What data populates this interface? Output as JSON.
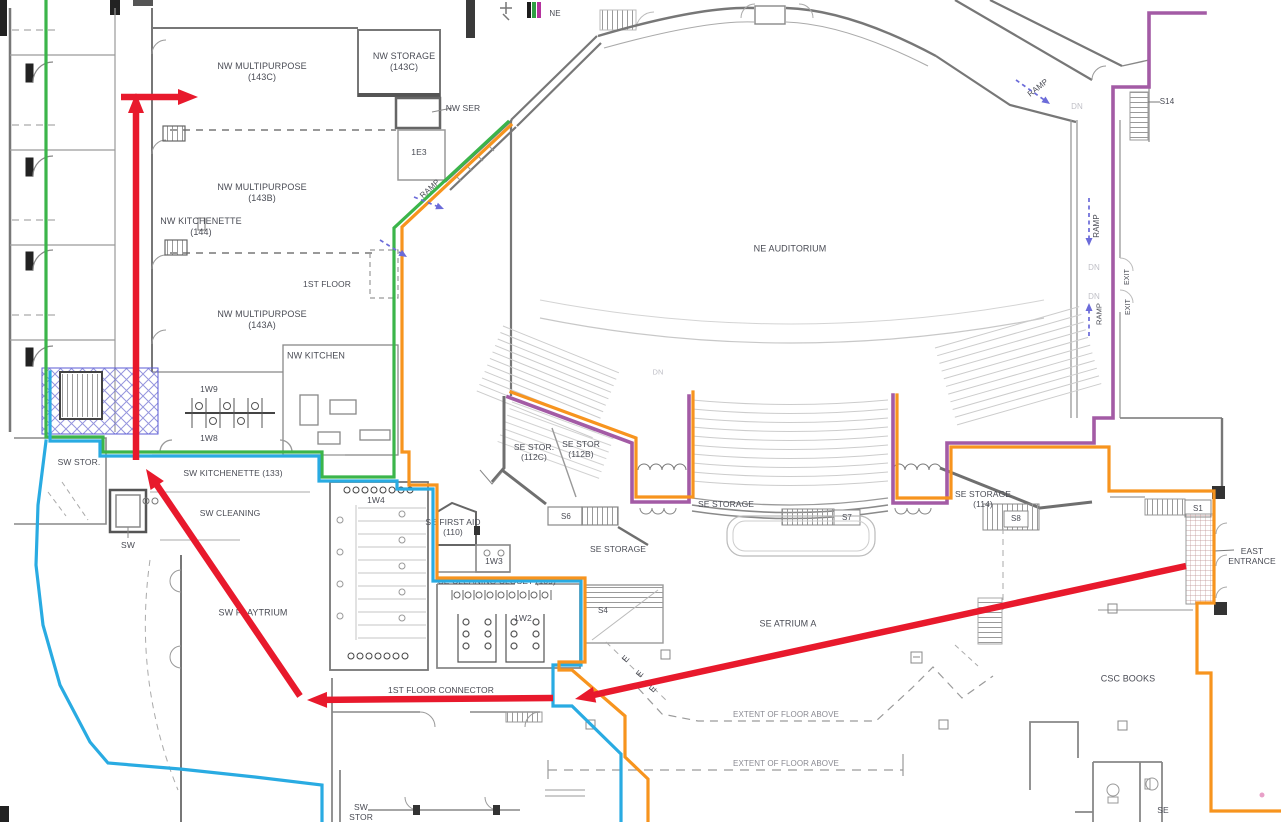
{
  "map_title": "First floor plan with wayfinding routes",
  "colors": {
    "red": "#E8192C",
    "blue": "#29ABE2",
    "orange": "#F7941E",
    "green": "#3BB54A",
    "purple": "#A35BA5",
    "ramp_arrow": "#6B6BD9",
    "text": "#4A4C55",
    "text_dim": "#BFBFC6"
  },
  "color_key_bars": [
    "#1C1C1C",
    "#2F9E43",
    "#B5329E"
  ],
  "labels": [
    {
      "name": "ne-corner",
      "text": "NE",
      "x": 555,
      "y": 14,
      "size": 8
    },
    {
      "name": "nw-multipurpose-143c",
      "text": "NW MULTIPURPOSE\n(143C)",
      "x": 262,
      "y": 72
    },
    {
      "name": "nw-storage-143c",
      "text": "NW STORAGE\n(143C)",
      "x": 404,
      "y": 62
    },
    {
      "name": "nw-ser",
      "text": "NW SER",
      "x": 463,
      "y": 108,
      "size": 8.5
    },
    {
      "name": "room-1e3",
      "text": "1E3",
      "x": 419,
      "y": 152,
      "size": 8.5
    },
    {
      "name": "ramp-nw",
      "text": "RAMP",
      "x": 430,
      "y": 189,
      "size": 8,
      "rot": -42
    },
    {
      "name": "nw-multipurpose-143b",
      "text": "NW MULTIPURPOSE\n(143B)",
      "x": 262,
      "y": 193
    },
    {
      "name": "nw-kitchenette-144",
      "text": "NW KITCHENETTE\n(144)",
      "x": 201,
      "y": 227
    },
    {
      "name": "first-floor",
      "text": "1ST FLOOR",
      "x": 327,
      "y": 284,
      "size": 8.5
    },
    {
      "name": "nw-multipurpose-143a",
      "text": "NW MULTIPURPOSE\n(143A)",
      "x": 262,
      "y": 320
    },
    {
      "name": "nw-kitchen",
      "text": "NW KITCHEN",
      "x": 316,
      "y": 356
    },
    {
      "name": "ne-auditorium",
      "text": "NE AUDITORIUM",
      "x": 790,
      "y": 249
    },
    {
      "name": "ramp-ne",
      "text": "RAMP",
      "x": 1038,
      "y": 88,
      "size": 8,
      "rot": -38
    },
    {
      "name": "dn-ne",
      "text": "DN",
      "x": 1077,
      "y": 107,
      "size": 8,
      "color": "#BFBFC6"
    },
    {
      "name": "s14",
      "text": "S14",
      "x": 1167,
      "y": 102,
      "size": 8
    },
    {
      "name": "ramp-east-upper",
      "text": "RAMP",
      "x": 1097,
      "y": 226,
      "size": 8,
      "rot": -90
    },
    {
      "name": "dn-east-1",
      "text": "DN",
      "x": 1094,
      "y": 268,
      "size": 8,
      "color": "#BFBFC6"
    },
    {
      "name": "dn-east-2",
      "text": "DN",
      "x": 1094,
      "y": 297,
      "size": 8,
      "color": "#BFBFC6"
    },
    {
      "name": "ramp-east-lower",
      "text": "RAMP",
      "x": 1099,
      "y": 314,
      "size": 7.5,
      "rot": -90
    },
    {
      "name": "exit-upper",
      "text": "EXIT",
      "x": 1128,
      "y": 277,
      "size": 7,
      "rot": -90
    },
    {
      "name": "exit-lower",
      "text": "EXIT",
      "x": 1129,
      "y": 307,
      "size": 7,
      "rot": -90
    },
    {
      "name": "room-1w9",
      "text": "1W9",
      "x": 209,
      "y": 389,
      "size": 8.5
    },
    {
      "name": "room-1w8",
      "text": "1W8",
      "x": 209,
      "y": 438,
      "size": 8.5
    },
    {
      "name": "sw-stor",
      "text": "SW STOR.",
      "x": 79,
      "y": 462,
      "size": 8.5
    },
    {
      "name": "sw-kitchenette-133",
      "text": "SW KITCHENETTE (133)",
      "x": 233,
      "y": 473,
      "size": 8.5
    },
    {
      "name": "sw-cleaning",
      "text": "SW CLEANING",
      "x": 230,
      "y": 513,
      "size": 8.5
    },
    {
      "name": "sw-elevator",
      "text": "SW",
      "x": 128,
      "y": 545,
      "size": 8.5
    },
    {
      "name": "sw-playtrium",
      "text": "SW PLAYTRIUM",
      "x": 253,
      "y": 613
    },
    {
      "name": "room-1w4",
      "text": "1W4",
      "x": 376,
      "y": 500,
      "size": 8.5
    },
    {
      "name": "se-first-aid-110",
      "text": "SE FIRST AID\n(110)",
      "x": 453,
      "y": 527,
      "size": 8.5
    },
    {
      "name": "room-1w3",
      "text": "1W3",
      "x": 494,
      "y": 561,
      "size": 8.5
    },
    {
      "name": "se-cleaning-closet-109",
      "text": "SE CLEANING CLOSET (109)",
      "x": 497,
      "y": 581,
      "size": 8.5
    },
    {
      "name": "room-1w2",
      "text": "1W2",
      "x": 523,
      "y": 618,
      "size": 8.5
    },
    {
      "name": "s4",
      "text": "S4",
      "x": 603,
      "y": 611,
      "size": 8
    },
    {
      "name": "s6",
      "text": "S6",
      "x": 566,
      "y": 517,
      "size": 8
    },
    {
      "name": "se-storage-south",
      "text": "SE STORAGE",
      "x": 618,
      "y": 549,
      "size": 8.5
    },
    {
      "name": "se-stor-112c",
      "text": "SE STOR.\n(112C)",
      "x": 534,
      "y": 452,
      "size": 8.5
    },
    {
      "name": "se-stor-112b",
      "text": "SE STOR\n(112B)",
      "x": 581,
      "y": 449,
      "size": 8.5
    },
    {
      "name": "se-storage-mid",
      "text": "SE STORAGE",
      "x": 726,
      "y": 504,
      "size": 8.5
    },
    {
      "name": "s7",
      "text": "S7",
      "x": 847,
      "y": 518,
      "size": 8
    },
    {
      "name": "se-storage-114",
      "text": "SE STORAGE\n(114)",
      "x": 983,
      "y": 499,
      "size": 8.5
    },
    {
      "name": "s8",
      "text": "S8",
      "x": 1016,
      "y": 519,
      "size": 8
    },
    {
      "name": "s1",
      "text": "S1",
      "x": 1198,
      "y": 509,
      "size": 8
    },
    {
      "name": "east-entrance",
      "text": "EAST\nENTRANCE",
      "x": 1252,
      "y": 556,
      "size": 8.5
    },
    {
      "name": "se-atrium-a",
      "text": "SE ATRIUM A",
      "x": 788,
      "y": 624
    },
    {
      "name": "csc-books",
      "text": "CSC BOOKS",
      "x": 1128,
      "y": 679
    },
    {
      "name": "first-floor-connector",
      "text": "1ST FLOOR CONNECTOR",
      "x": 441,
      "y": 690,
      "size": 8.5
    },
    {
      "name": "extent-of-floor-above-upper",
      "text": "EXTENT OF FLOOR ABOVE",
      "x": 786,
      "y": 715,
      "size": 8,
      "color": "#8A8A92"
    },
    {
      "name": "extent-of-floor-above-lower",
      "text": "EXTENT OF FLOOR ABOVE",
      "x": 786,
      "y": 764,
      "size": 8,
      "color": "#8A8A92"
    },
    {
      "name": "sw-stor-bottom",
      "text": "SW\nSTOR",
      "x": 361,
      "y": 812,
      "size": 8.5
    },
    {
      "name": "se-bottom",
      "text": "SE",
      "x": 1163,
      "y": 810,
      "size": 8.5
    },
    {
      "name": "dn-auditorium",
      "text": "DN",
      "x": 658,
      "y": 372,
      "size": 7.5,
      "color": "#BFBFC6"
    },
    {
      "name": "grid-e-1",
      "text": "E",
      "x": 626,
      "y": 659,
      "size": 9,
      "rot": -50
    },
    {
      "name": "grid-e-2",
      "text": "E",
      "x": 640,
      "y": 674,
      "size": 9,
      "rot": -50
    },
    {
      "name": "grid-e-3",
      "text": "E",
      "x": 653,
      "y": 689,
      "size": 9,
      "rot": -50
    }
  ],
  "routes": [
    {
      "name": "route-green-west-to-ramp",
      "color": "green",
      "width": 3.2,
      "points": [
        [
          46,
          0
        ],
        [
          46,
          437
        ],
        [
          103,
          437
        ],
        [
          103,
          452
        ],
        [
          322,
          452
        ],
        [
          322,
          477
        ],
        [
          394,
          477
        ],
        [
          394,
          228
        ],
        [
          508,
          122
        ]
      ]
    },
    {
      "name": "route-blue-kitchenette-corridor",
      "color": "blue",
      "width": 3.2,
      "points": [
        [
          50,
          372
        ],
        [
          50,
          441
        ],
        [
          100,
          441
        ],
        [
          100,
          456
        ],
        [
          319,
          456
        ],
        [
          319,
          481
        ],
        [
          397,
          481
        ],
        [
          397,
          489
        ],
        [
          433,
          489
        ],
        [
          433,
          581
        ],
        [
          581,
          581
        ],
        [
          581,
          665
        ],
        [
          553,
          665
        ],
        [
          553,
          706
        ],
        [
          572,
          706
        ],
        [
          621,
          754
        ],
        [
          621,
          822
        ]
      ]
    },
    {
      "name": "route-blue-sw-atrium",
      "color": "blue",
      "width": 3.2,
      "points": [
        [
          46,
          441
        ],
        [
          38,
          505
        ],
        [
          36,
          565
        ],
        [
          43,
          625
        ],
        [
          60,
          685
        ],
        [
          90,
          742
        ],
        [
          108,
          763
        ],
        [
          180,
          769
        ],
        [
          255,
          777
        ],
        [
          322,
          785
        ],
        [
          322,
          822
        ]
      ]
    },
    {
      "name": "route-orange-west",
      "color": "orange",
      "width": 3.2,
      "points": [
        [
          511,
          125
        ],
        [
          402,
          227
        ],
        [
          402,
          452
        ],
        [
          409,
          452
        ],
        [
          409,
          485
        ],
        [
          437,
          485
        ],
        [
          437,
          578
        ],
        [
          585,
          578
        ],
        [
          585,
          662
        ],
        [
          559,
          662
        ],
        [
          559,
          670
        ],
        [
          572,
          670
        ],
        [
          625,
          716
        ],
        [
          625,
          757
        ],
        [
          648,
          779
        ],
        [
          648,
          822
        ]
      ]
    },
    {
      "name": "route-purple-east-ramp",
      "color": "purple",
      "width": 3.6,
      "points": [
        [
          1205,
          13
        ],
        [
          1149,
          13
        ],
        [
          1149,
          87
        ],
        [
          1113,
          87
        ],
        [
          1113,
          418
        ],
        [
          1094,
          418
        ],
        [
          1094,
          443
        ],
        [
          947,
          443
        ],
        [
          947,
          503
        ],
        [
          893,
          503
        ],
        [
          893,
          395
        ]
      ]
    },
    {
      "name": "route-orange-east-entrance",
      "color": "orange",
      "width": 3.2,
      "points": [
        [
          897,
          395
        ],
        [
          897,
          498
        ],
        [
          951,
          498
        ],
        [
          951,
          447
        ],
        [
          1090,
          447
        ],
        [
          1109,
          447
        ],
        [
          1109,
          491
        ],
        [
          1214,
          491
        ],
        [
          1214,
          603
        ],
        [
          1197,
          603
        ],
        [
          1197,
          673
        ],
        [
          1211,
          673
        ],
        [
          1211,
          811
        ],
        [
          1281,
          811
        ]
      ]
    },
    {
      "name": "route-purple-se-stor-wedge",
      "color": "purple",
      "width": 3.6,
      "points": [
        [
          508,
          397
        ],
        [
          632,
          443
        ],
        [
          632,
          502
        ],
        [
          689,
          502
        ],
        [
          689,
          396
        ]
      ]
    },
    {
      "name": "route-orange-se-stor-wedge",
      "color": "orange",
      "width": 3.2,
      "points": [
        [
          511,
          392
        ],
        [
          636,
          438
        ],
        [
          636,
          497
        ],
        [
          693,
          497
        ],
        [
          693,
          392
        ]
      ]
    }
  ],
  "red_arrows": [
    {
      "name": "red-arrow-east-entrance-to-connector",
      "from": [
        1186,
        566
      ],
      "to": [
        575,
        699
      ]
    },
    {
      "name": "red-arrow-connector-west",
      "from": [
        553,
        698
      ],
      "to": [
        307,
        700
      ]
    },
    {
      "name": "red-arrow-connector-to-sw",
      "from": [
        300,
        696
      ],
      "to": [
        146,
        469
      ]
    },
    {
      "name": "red-arrow-sw-north",
      "from": [
        136,
        460
      ],
      "to": [
        136,
        93
      ]
    },
    {
      "name": "red-arrow-into-143c",
      "from": [
        121,
        97
      ],
      "to": [
        198,
        97
      ]
    }
  ],
  "ramp_arrows": [
    {
      "name": "ramp-arrow-1e3",
      "from": [
        414,
        197
      ],
      "to": [
        444,
        209
      ]
    },
    {
      "name": "ramp-arrow-ne",
      "from": [
        1016,
        80
      ],
      "to": [
        1050,
        104
      ]
    },
    {
      "name": "ramp-arrow-east-down",
      "from": [
        1089,
        198
      ],
      "to": [
        1089,
        246
      ]
    },
    {
      "name": "ramp-arrow-east-up",
      "from": [
        1089,
        336
      ],
      "to": [
        1089,
        303
      ]
    },
    {
      "name": "ramp-arrow-nw-corridor",
      "from": [
        380,
        240
      ],
      "to": [
        407,
        257
      ]
    }
  ]
}
